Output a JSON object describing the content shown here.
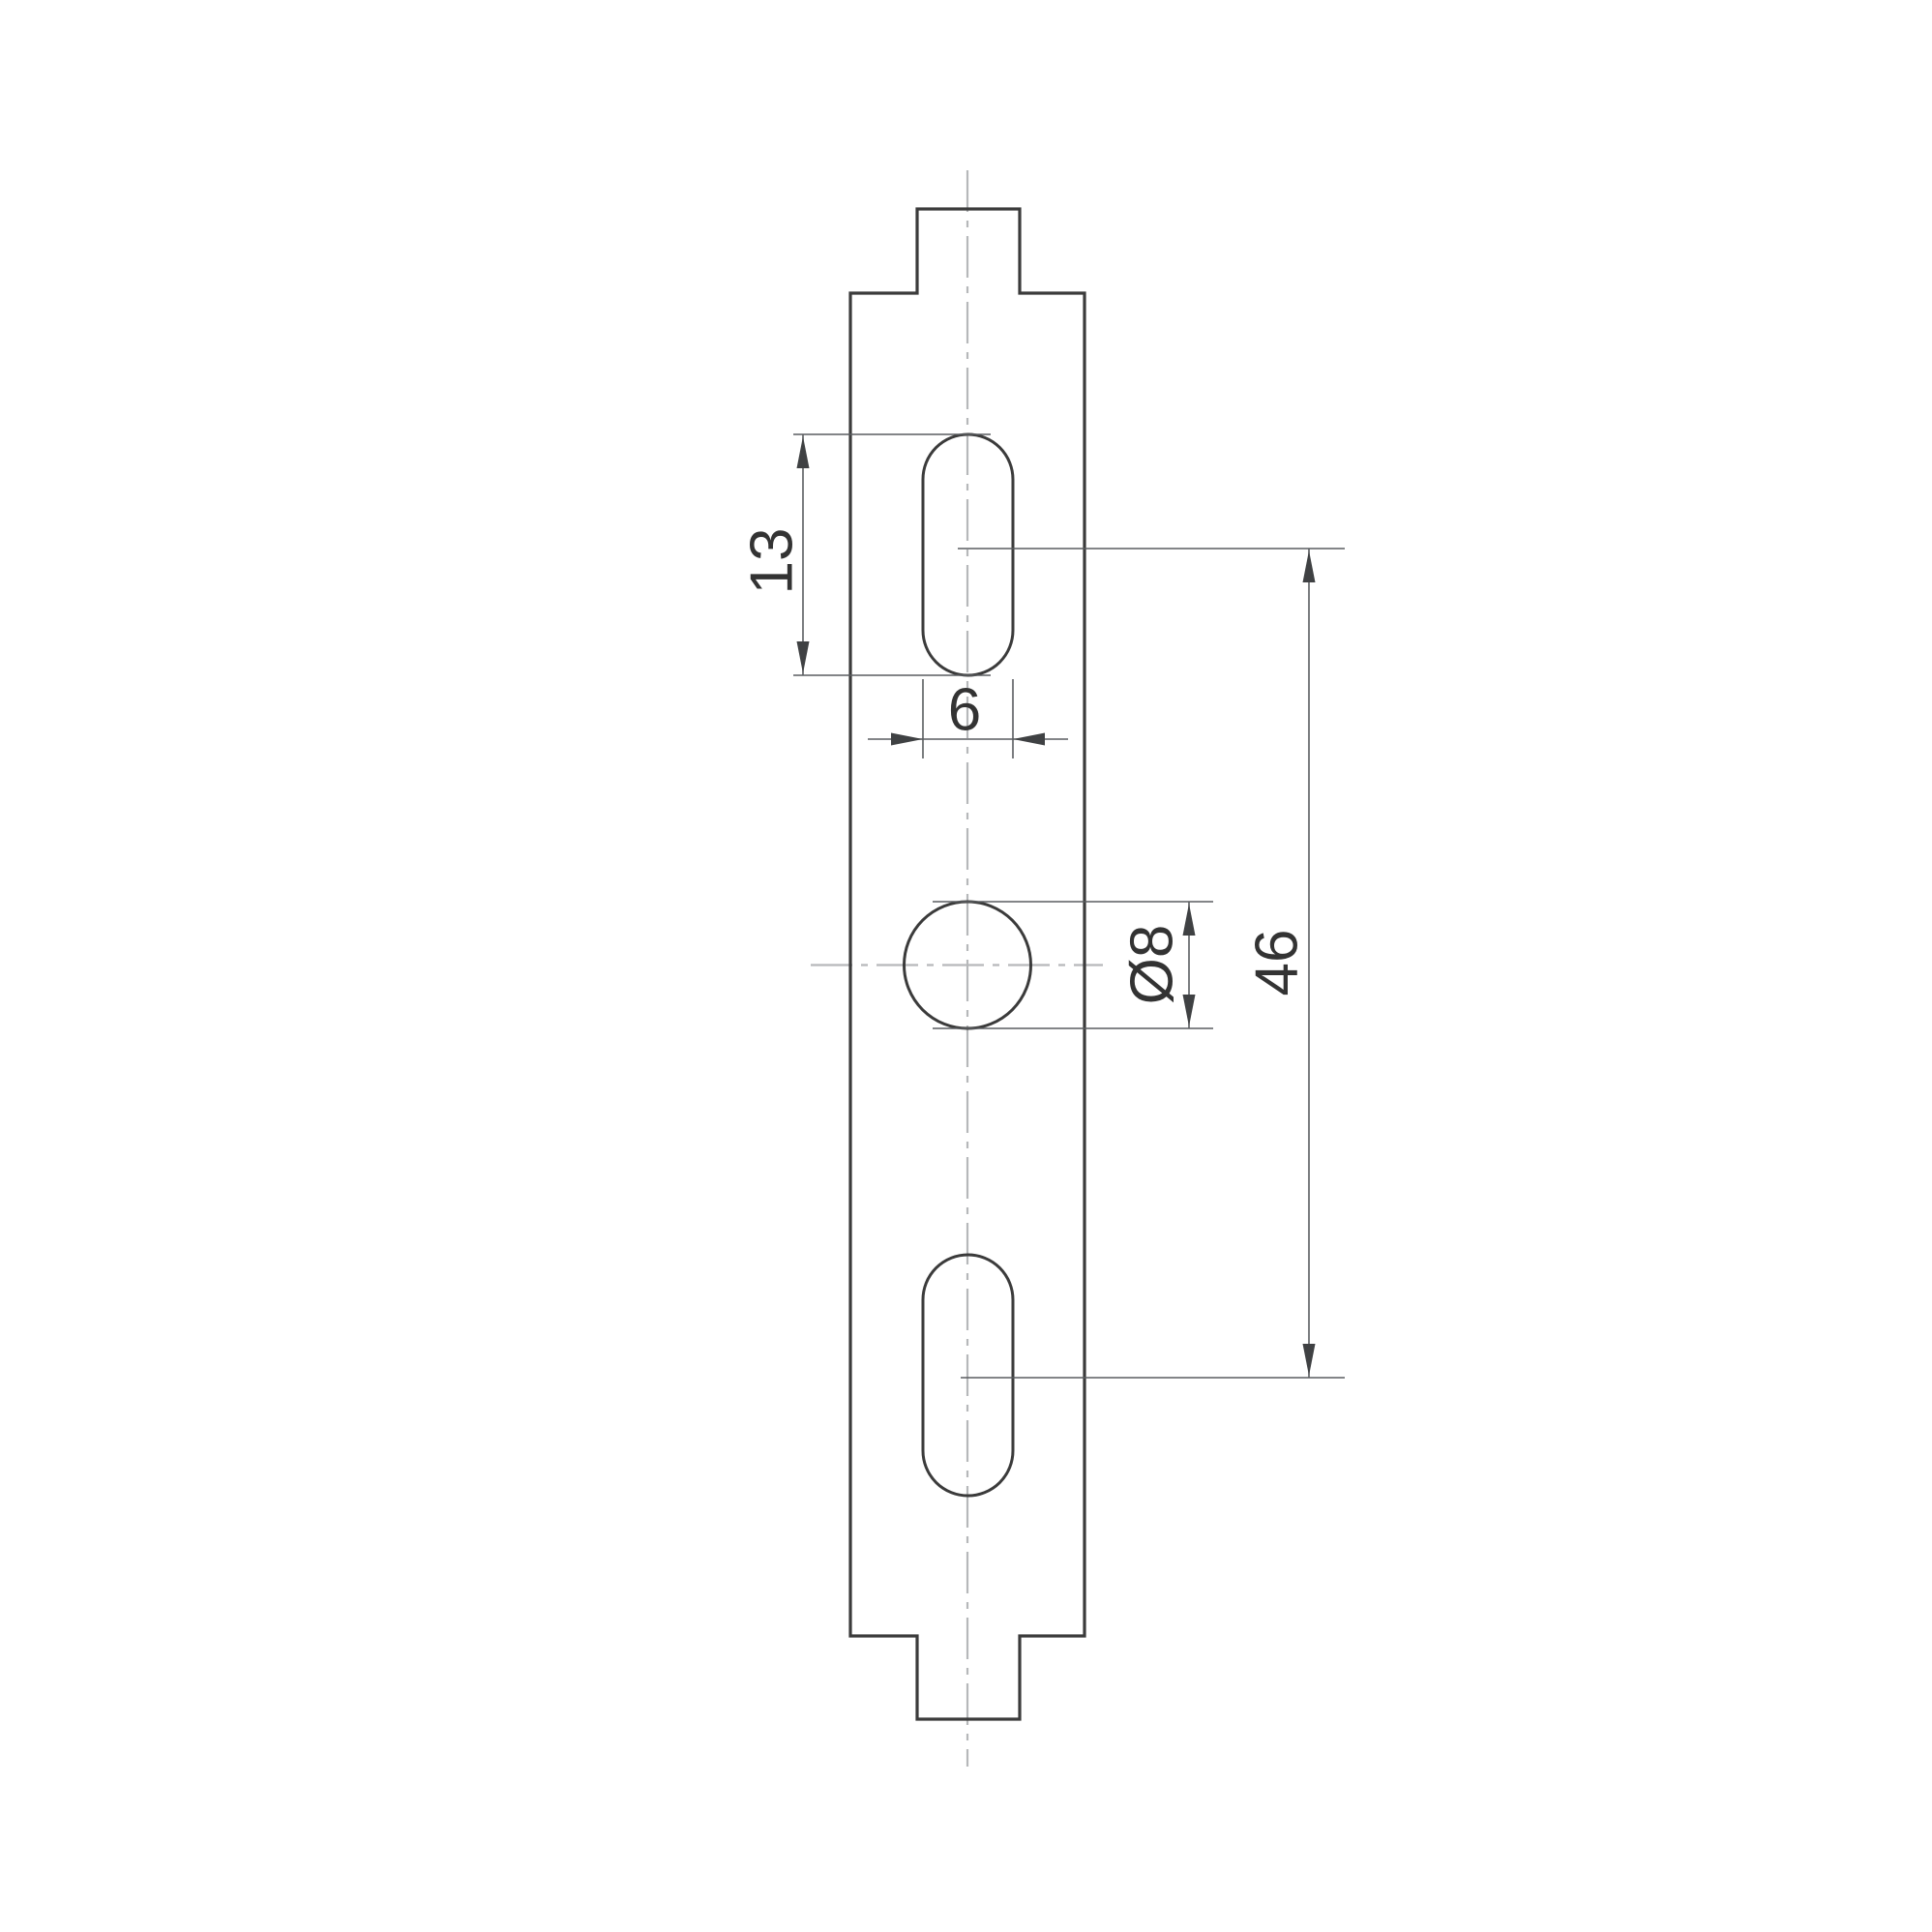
{
  "drawing": {
    "kind": "technical-drawing",
    "part": "mounting-strip-with-tabs"
  },
  "dimensions": {
    "slot_length": {
      "label": "13"
    },
    "slot_width": {
      "label": "6"
    },
    "hole_diameter": {
      "label": "Ø8"
    },
    "slot_center_distance": {
      "label": "46"
    }
  },
  "colors": {
    "background": "#ffffff",
    "outline": "#3b3b3b",
    "dimension": "#5a5d60",
    "centerline": "#b6b8ba",
    "text": "#333333",
    "arrow": "#3f4143"
  }
}
